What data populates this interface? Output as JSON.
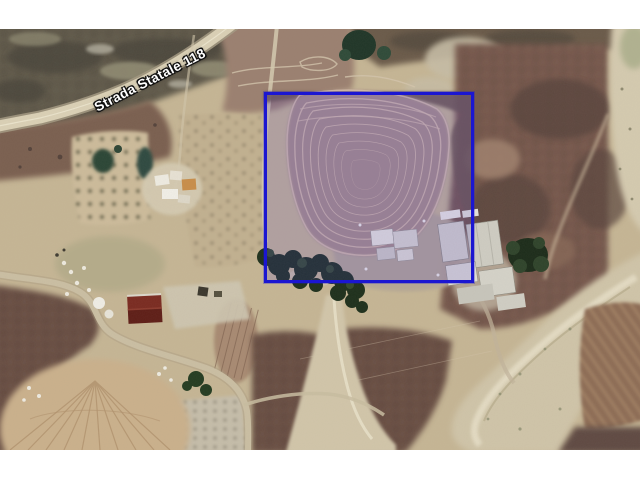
{
  "window": {
    "background_color": "#ffffff",
    "content_description": "Aerial satellite photograph of rural farmland with a highlighted parcel"
  },
  "map": {
    "road_label": "Strada Statale 118",
    "highlight_box": {
      "border_color": "#1b16d1",
      "fill_tint": "rgba(76,62,216,0.17)"
    }
  }
}
